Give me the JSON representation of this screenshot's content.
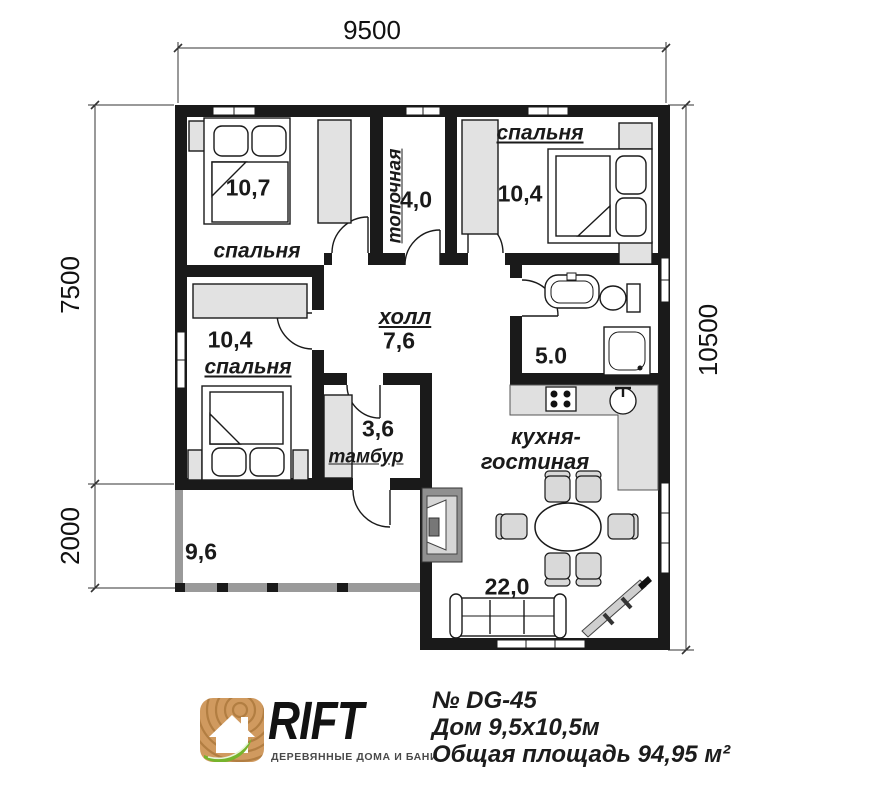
{
  "dimensions": {
    "top": "9500",
    "left_upper": "7500",
    "left_lower": "2000",
    "right": "10500"
  },
  "rooms": {
    "bedroom_top_left": {
      "name": "спальня",
      "area": "10,7"
    },
    "boiler": {
      "name": "топочная",
      "area": "4,0"
    },
    "bedroom_top_right": {
      "name": "спальня",
      "area": "10,4"
    },
    "bedroom_mid_left": {
      "name": "спальня",
      "area": "10,4"
    },
    "hall": {
      "name": "холл",
      "area": "7,6"
    },
    "bathroom": {
      "area": "5.0"
    },
    "vestibule": {
      "name": "тамбур",
      "area": "3,6"
    },
    "kitchen_living": {
      "name_line1": "кухня-",
      "name_line2": "гостиная",
      "area": "22,0"
    },
    "terrace": {
      "area": "9,6"
    }
  },
  "branding": {
    "logo_text": "RIFT",
    "tagline": "ДЕРЕВЯННЫЕ ДОМА И БАНИ",
    "project_no": "№ DG-45",
    "house_size": "Дом 9,5х10,5м",
    "total_area": "Общая площадь 94,95 м²"
  },
  "colors": {
    "wall": "#1a1a1a",
    "furniture": "#e2e2e2",
    "counter": "#e0e0e0",
    "terrace_wall": "#9a9a9a",
    "logo_wood": "#d09a5f",
    "logo_rings": "#ad7a3e",
    "logo_leaf": "#76b42c"
  }
}
